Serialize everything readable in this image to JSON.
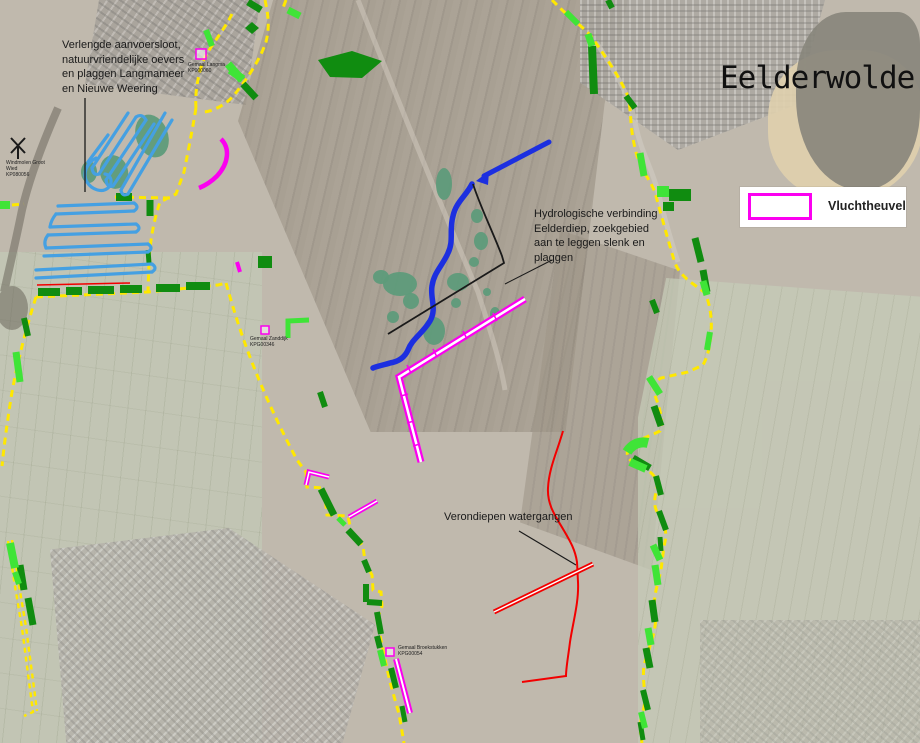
{
  "title": "Eelderwolde",
  "legend": {
    "label": "Vluchtheuvel"
  },
  "annotations": {
    "langmameer": "Verlengde aanvoersloot,\nnatuurvriendelijke oevers\nen plaggen Langmameer\nen Nieuwe Weering",
    "hydrologisch": "Hydrologische verbinding\nEelderdiep, zoekgebied\naan te leggen slenk en\nplaggen",
    "verondiepen": "Verondiepen watergangen"
  },
  "map_labels": {
    "langma": {
      "text": "Gemaal Langma",
      "code": "KP000060"
    },
    "windmolen": {
      "text": "Windmolen Groot Wied",
      "code": "KP080056"
    },
    "zanddijk": {
      "text": "Gemaal Zanddijk",
      "code": "KPG00346"
    },
    "broekstukken": {
      "text": "Gemaal Broekstukken",
      "code": "KPG00054"
    }
  },
  "icons": {
    "windmill": "windmill-icon",
    "arrow": "flow-arrow-icon"
  },
  "colors": {
    "yellow_boundary": "#ffe800",
    "dark_green": "#108c10",
    "bright_green": "#3fe437",
    "magenta": "#fb00f0",
    "blue_canal": "#1c2fe0",
    "light_blue": "#45a0e2",
    "teal_patch": "#5e9b7a",
    "red_line": "#f20000",
    "black_line": "#1a1a1a"
  }
}
